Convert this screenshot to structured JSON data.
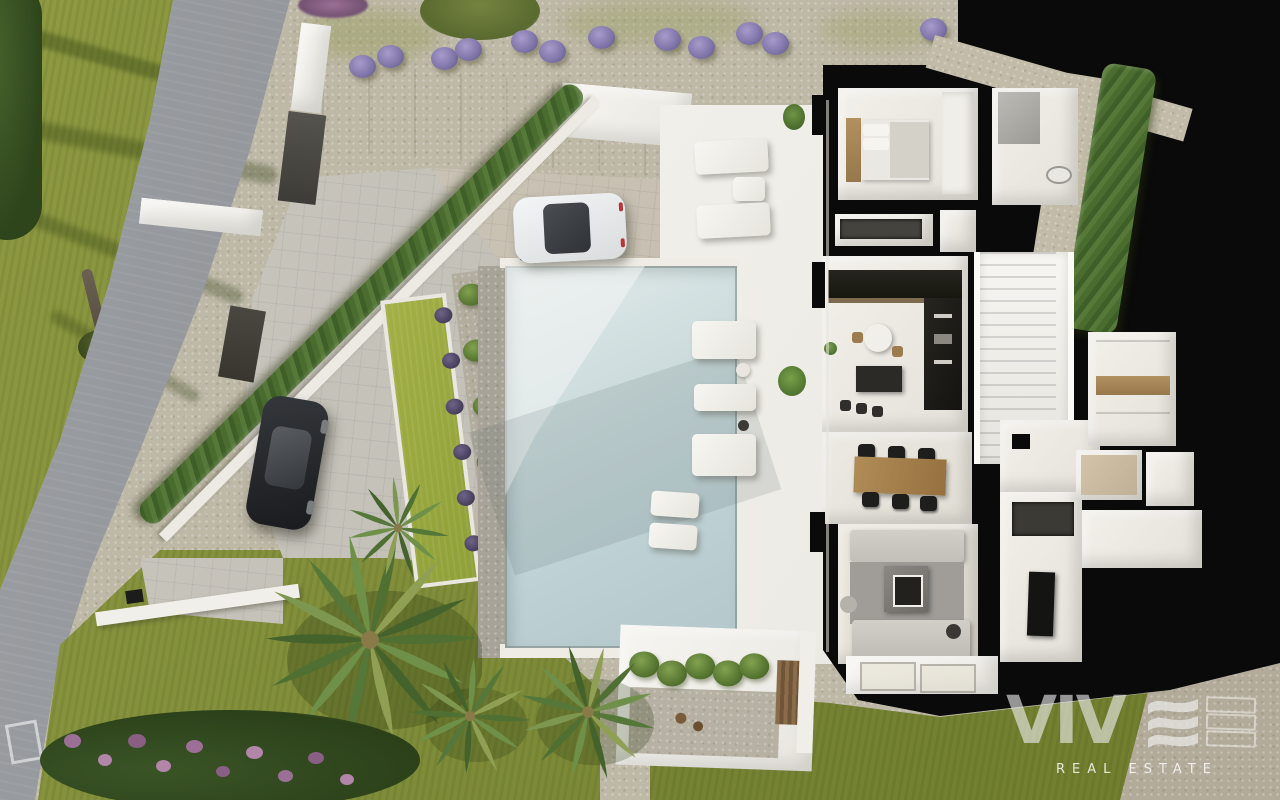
{
  "watermark": {
    "brand": "VIVE",
    "brand_prefix": "VIV",
    "tagline": "REAL ESTATE"
  },
  "palette": {
    "gravel": "#beb8a7",
    "grass": "#7d8a38",
    "lawn": "#9aa83e",
    "road": "#8e9195",
    "plan_black": "#0a0a0a",
    "terrace_white": "#f0efe9",
    "pool_water": "#c5d6d8",
    "hedge_green": "#4a6c2e",
    "lavender": "#8d83b5",
    "wood": "#a8854f",
    "sofa_gray": "#cbc8c2"
  },
  "scene": {
    "setting": "aerial top-down 3D render of a modern villa with cutaway floor plan",
    "features": [
      "swimming pool",
      "white terraces",
      "floor-plan cutaway",
      "palm trees",
      "white car",
      "black car",
      "cypress hedge",
      "curved road",
      "lavender bushes",
      "sun loungers"
    ]
  }
}
